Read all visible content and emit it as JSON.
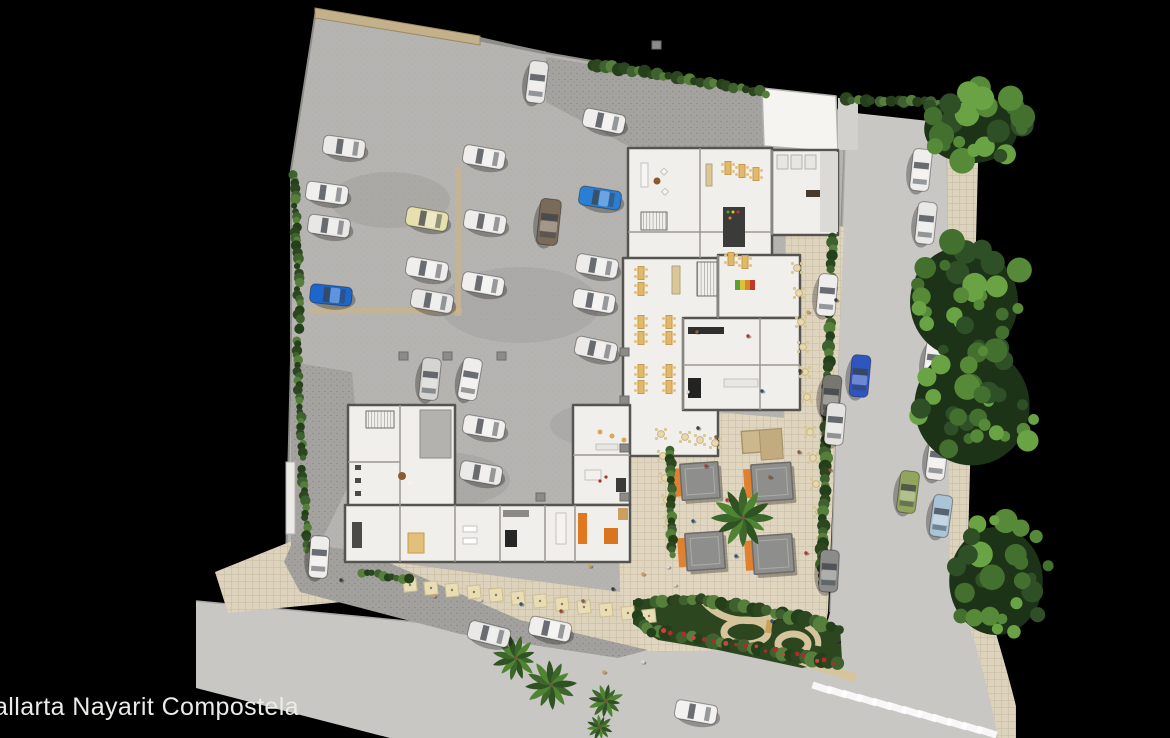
{
  "caption": {
    "text": "allarta Nayarit Compostela"
  },
  "palette": {
    "background": "#000000",
    "concrete": "#b6b4b1",
    "asphalt": "#c9c7c4",
    "paver": "#dfd5bf",
    "drive": "#a5a39f",
    "building": "#f0efeb",
    "wall": "#55544e",
    "hedge": "#2c461f",
    "tree_greens": [
      "#2f4f26",
      "#44702f",
      "#578a38",
      "#6aa344"
    ],
    "palm_greens": [
      "#3c662a",
      "#4f8433",
      "#2f5222"
    ],
    "table_tan": "#e2b86a",
    "umbrella": "#e9ddb6",
    "accent_orange": "#e07820",
    "flower_red": "#b22a2a",
    "canopy_gray": "#8e8e8c",
    "marking_tan": "#c8b48e"
  },
  "scene": {
    "cars": [
      {
        "x": 537,
        "y": 82,
        "a": 97,
        "c": "#e9e8e6"
      },
      {
        "x": 604,
        "y": 121,
        "a": 12,
        "c": "#efeeec"
      },
      {
        "x": 344,
        "y": 147,
        "a": 8,
        "c": "#eceae8"
      },
      {
        "x": 327,
        "y": 193,
        "a": 8,
        "c": "#f0efed"
      },
      {
        "x": 329,
        "y": 226,
        "a": 8,
        "c": "#e8e7e5"
      },
      {
        "x": 484,
        "y": 157,
        "a": 10,
        "c": "#efeeec"
      },
      {
        "x": 427,
        "y": 219,
        "a": 10,
        "c": "#e6e0ae"
      },
      {
        "x": 485,
        "y": 222,
        "a": 10,
        "c": "#eeedeb"
      },
      {
        "x": 549,
        "y": 222,
        "a": 96,
        "c": "#7a6a58",
        "l": 46,
        "w": 21
      },
      {
        "x": 600,
        "y": 198,
        "a": 9,
        "c": "#2a7fd4"
      },
      {
        "x": 331,
        "y": 295,
        "a": 6,
        "c": "#1d66cc"
      },
      {
        "x": 427,
        "y": 269,
        "a": 10,
        "c": "#efeeec"
      },
      {
        "x": 432,
        "y": 301,
        "a": 10,
        "c": "#e9e8e6"
      },
      {
        "x": 483,
        "y": 284,
        "a": 10,
        "c": "#f0efed"
      },
      {
        "x": 597,
        "y": 266,
        "a": 10,
        "c": "#edecea"
      },
      {
        "x": 594,
        "y": 301,
        "a": 10,
        "c": "#f1f0ee"
      },
      {
        "x": 596,
        "y": 349,
        "a": 12,
        "c": "#eceae8"
      },
      {
        "x": 430,
        "y": 379,
        "a": 96,
        "c": "#d5d4d2"
      },
      {
        "x": 470,
        "y": 379,
        "a": 100,
        "c": "#eeedeb"
      },
      {
        "x": 484,
        "y": 427,
        "a": 10,
        "c": "#f0efed"
      },
      {
        "x": 481,
        "y": 473,
        "a": 10,
        "c": "#eceae8"
      },
      {
        "x": 319,
        "y": 557,
        "a": 94,
        "c": "#eeedeb"
      },
      {
        "x": 489,
        "y": 634,
        "a": 14,
        "c": "#e9e8e6"
      },
      {
        "x": 550,
        "y": 629,
        "a": 12,
        "c": "#f0efec"
      },
      {
        "x": 696,
        "y": 712,
        "a": 10,
        "c": "#f2f1ef"
      },
      {
        "x": 921,
        "y": 170,
        "a": 96,
        "c": "#efeeec"
      },
      {
        "x": 926,
        "y": 223,
        "a": 96,
        "c": "#e9e8e6"
      },
      {
        "x": 929,
        "y": 282,
        "a": 97,
        "c": "#f0efed"
      },
      {
        "x": 827,
        "y": 295,
        "a": 95,
        "c": "#eeedeb"
      },
      {
        "x": 934,
        "y": 362,
        "a": 97,
        "c": "#f1f0ee"
      },
      {
        "x": 860,
        "y": 376,
        "a": 95,
        "c": "#2e55c0"
      },
      {
        "x": 937,
        "y": 459,
        "a": 97,
        "c": "#eeedeb"
      },
      {
        "x": 908,
        "y": 492,
        "a": 97,
        "c": "#93a45c"
      },
      {
        "x": 941,
        "y": 516,
        "a": 98,
        "c": "#a9c4d6"
      },
      {
        "x": 831,
        "y": 396,
        "a": 95,
        "c": "#77766f"
      },
      {
        "x": 835,
        "y": 424,
        "a": 95,
        "c": "#e4e3e1"
      },
      {
        "x": 829,
        "y": 571,
        "a": 93,
        "c": "#8b8b89"
      }
    ],
    "trees": [
      {
        "cx": 975,
        "cy": 125,
        "rx": 52,
        "ry": 38,
        "n": 26
      },
      {
        "cx": 968,
        "cy": 298,
        "rx": 60,
        "ry": 62,
        "n": 30
      },
      {
        "cx": 976,
        "cy": 402,
        "rx": 64,
        "ry": 66,
        "n": 32
      },
      {
        "cx": 1000,
        "cy": 577,
        "rx": 52,
        "ry": 60,
        "n": 26
      }
    ],
    "palms": [
      {
        "x": 743,
        "y": 518,
        "r": 28
      },
      {
        "x": 516,
        "y": 658,
        "r": 21
      },
      {
        "x": 551,
        "y": 685,
        "r": 23
      },
      {
        "x": 606,
        "y": 701,
        "r": 16
      },
      {
        "x": 600,
        "y": 727,
        "r": 12
      }
    ],
    "hedges": [
      {
        "x1": 592,
        "y1": 64,
        "x2": 766,
        "y2": 93,
        "r": 5
      },
      {
        "x1": 846,
        "y1": 100,
        "x2": 990,
        "y2": 104,
        "r": 5
      },
      {
        "x1": 294,
        "y1": 174,
        "x2": 300,
        "y2": 330,
        "r": 4
      },
      {
        "x1": 296,
        "y1": 340,
        "x2": 303,
        "y2": 458,
        "r": 4
      },
      {
        "x1": 302,
        "y1": 470,
        "x2": 308,
        "y2": 550,
        "r": 4
      },
      {
        "x1": 833,
        "y1": 237,
        "x2": 821,
        "y2": 583,
        "r": 5
      },
      {
        "x1": 670,
        "y1": 449,
        "x2": 672,
        "y2": 556,
        "r": 4
      },
      {
        "x1": 362,
        "y1": 572,
        "x2": 408,
        "y2": 580,
        "r": 4
      },
      {
        "x1": 640,
        "y1": 604,
        "x2": 700,
        "y2": 599,
        "r": 6
      },
      {
        "x1": 700,
        "y1": 599,
        "x2": 782,
        "y2": 614,
        "r": 6
      },
      {
        "x1": 782,
        "y1": 614,
        "x2": 838,
        "y2": 629,
        "r": 6
      },
      {
        "x1": 660,
        "y1": 632,
        "x2": 836,
        "y2": 662,
        "r": 6
      },
      {
        "x1": 636,
        "y1": 616,
        "x2": 652,
        "y2": 634,
        "r": 5
      }
    ],
    "canopies": [
      {
        "x": 700,
        "y": 481,
        "w": 38,
        "h": 36
      },
      {
        "x": 772,
        "y": 482,
        "w": 40,
        "h": 37
      },
      {
        "x": 705,
        "y": 551,
        "w": 38,
        "h": 37
      },
      {
        "x": 773,
        "y": 554,
        "w": 40,
        "h": 38
      }
    ],
    "pergola": {
      "x": 762,
      "y": 441,
      "w": 40,
      "h": 22
    },
    "tables": {
      "plaza": [
        [
          661,
          434
        ],
        [
          663,
          456
        ],
        [
          665,
          478
        ],
        [
          667,
          500
        ],
        [
          669,
          522
        ],
        [
          671,
          544
        ],
        [
          685,
          437
        ],
        [
          700,
          440
        ],
        [
          715,
          443
        ]
      ],
      "street": [
        [
          797,
          268
        ],
        [
          799,
          293
        ],
        [
          801,
          322
        ],
        [
          803,
          347
        ],
        [
          805,
          372
        ],
        [
          807,
          397
        ],
        [
          810,
          432
        ],
        [
          813,
          458
        ],
        [
          816,
          484
        ],
        [
          819,
          512
        ],
        [
          822,
          542
        ],
        [
          824,
          570
        ]
      ],
      "umbrellas": [
        [
          410,
          585
        ],
        [
          431,
          588
        ],
        [
          452,
          590
        ],
        [
          474,
          592
        ],
        [
          496,
          595
        ],
        [
          518,
          598
        ],
        [
          540,
          601
        ],
        [
          562,
          604
        ],
        [
          584,
          607
        ],
        [
          606,
          610
        ],
        [
          628,
          613
        ],
        [
          649,
          616
        ]
      ],
      "interior": [
        [
          641,
          273
        ],
        [
          641,
          289
        ],
        [
          641,
          322
        ],
        [
          641,
          338
        ],
        [
          641,
          371
        ],
        [
          641,
          387
        ],
        [
          669,
          322
        ],
        [
          669,
          338
        ],
        [
          669,
          371
        ],
        [
          669,
          387
        ],
        [
          728,
          168
        ],
        [
          742,
          171
        ],
        [
          756,
          174
        ],
        [
          731,
          259
        ],
        [
          745,
          262
        ]
      ]
    },
    "people": [
      [
        698,
        428
      ],
      [
        716,
        437
      ],
      [
        727,
        500
      ],
      [
        693,
        521
      ],
      [
        668,
        567
      ],
      [
        643,
        574
      ],
      [
        613,
        589
      ],
      [
        583,
        601
      ],
      [
        561,
        611
      ],
      [
        521,
        604
      ],
      [
        480,
        600
      ],
      [
        434,
        596
      ],
      [
        341,
        580
      ],
      [
        697,
        332
      ],
      [
        748,
        336
      ],
      [
        762,
        391
      ],
      [
        688,
        392
      ],
      [
        808,
        312
      ],
      [
        800,
        371
      ],
      [
        799,
        452
      ],
      [
        806,
        553
      ],
      [
        772,
        621
      ],
      [
        643,
        662
      ],
      [
        604,
        672
      ],
      [
        838,
        641
      ],
      [
        770,
        477
      ],
      [
        706,
        466
      ],
      [
        736,
        556
      ],
      [
        675,
        585
      ],
      [
        590,
        566
      ],
      [
        836,
        300
      ],
      [
        830,
        470
      ]
    ],
    "columns": [
      [
        403,
        356
      ],
      [
        447,
        356
      ],
      [
        501,
        356
      ],
      [
        624,
        352
      ],
      [
        624,
        400
      ],
      [
        624,
        448
      ],
      [
        540,
        497
      ],
      [
        624,
        497
      ],
      [
        656,
        45
      ]
    ],
    "markings": [
      {
        "x": 455,
        "y": 168,
        "w": 6,
        "h": 148
      },
      {
        "x": 310,
        "y": 308,
        "w": 152,
        "h": 6
      }
    ],
    "crosswalk": {
      "x0": 822,
      "y0": 688,
      "dx": 15,
      "dy": 4.0,
      "n": 12,
      "w": 20,
      "h": 7,
      "angle": 18
    },
    "flowers": {
      "x1": 662,
      "y1": 630,
      "x2": 836,
      "y2": 663,
      "n": 18
    }
  }
}
